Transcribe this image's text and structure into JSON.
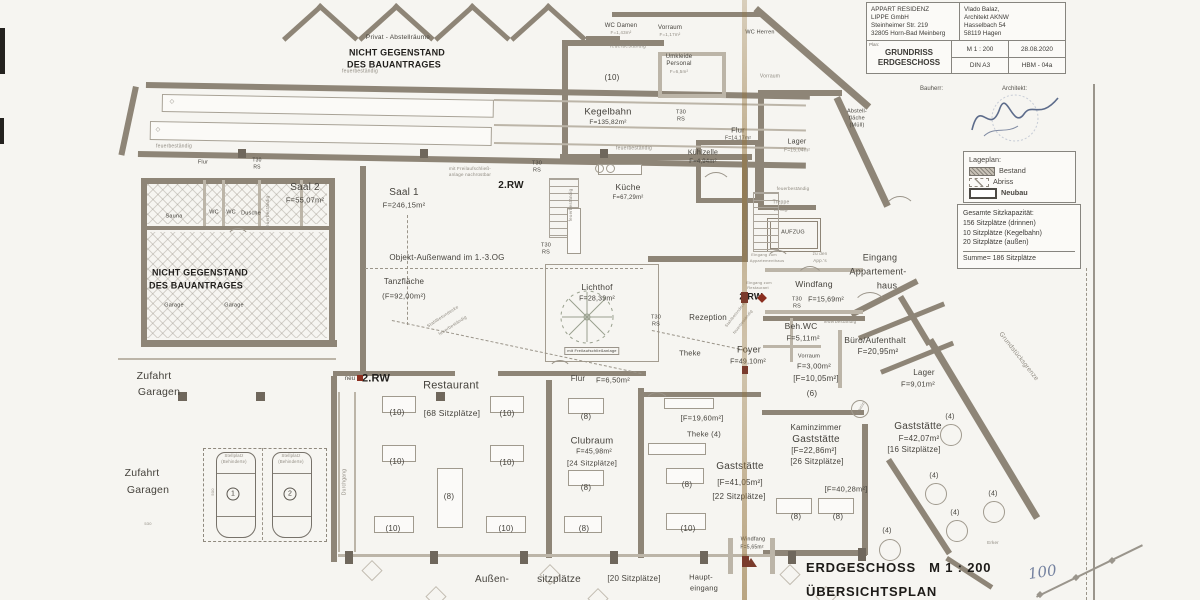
{
  "title_block": {
    "client": [
      "APPART RESIDENZ",
      "LIPPE  GmbH",
      "Steinheimer Str. 219",
      "32805 Horn-Bad Meinberg"
    ],
    "architect": [
      "Vlado Balaz,",
      "Architekt AKNW",
      "Hasselbach 54",
      "58119 Hagen"
    ],
    "plan_tag": "Plan:",
    "plan_name1": "GRUNDRISS",
    "plan_name2": "ERDGESCHOSS",
    "scale": "M 1 : 200",
    "date": "28.08.2020",
    "format": "DIN A3",
    "sheet": "HBM - 04a",
    "bauherr_label": "Bauherr:",
    "architekt_label": "Architekt:"
  },
  "legend": {
    "title": "Lageplan:",
    "items": [
      {
        "label": "Bestand",
        "style": "hatched"
      },
      {
        "label": "Abriss",
        "style": "dashed"
      },
      {
        "label": "Neubau",
        "style": "bold-outline"
      }
    ]
  },
  "capacity": {
    "lines": [
      "Gesamte Sitzkapazität:",
      "156 Sitzplätze (drinnen)",
      "10 Sitzplätze (Kegelbahn)",
      "20 Sitzplätze (außen)"
    ],
    "sum": "Summe= 186 Sitzplätze"
  },
  "footer": {
    "title": "ERDGESCHOSS   M 1 : 200",
    "subtitle": "ÜBERSICHTSPLAN",
    "handwritten": "100"
  },
  "plan": {
    "labels": [
      {
        "t": "Privat - Abstellräume",
        "x": 398,
        "y": 38,
        "s": 6.5
      },
      {
        "t": "NICHT GEGENSTAND",
        "x": 397,
        "y": 53,
        "s": 9,
        "b": 1
      },
      {
        "t": "DES BAUANTRAGES",
        "x": 394,
        "y": 65,
        "s": 9,
        "b": 1
      },
      {
        "t": "feuerbeständig",
        "x": 360,
        "y": 72,
        "s": 5,
        "c": "dim"
      },
      {
        "t": "feuerbeständig",
        "x": 174,
        "y": 147,
        "s": 5,
        "c": "dim"
      },
      {
        "t": "feuerbeständig",
        "x": 628,
        "y": 47,
        "s": 5,
        "c": "dim"
      },
      {
        "t": "feuerbeständig",
        "x": 634,
        "y": 149,
        "s": 5,
        "c": "dim"
      },
      {
        "t": "WC Damen",
        "x": 621,
        "y": 26,
        "s": 6
      },
      {
        "t": "F=1,43m²",
        "x": 621,
        "y": 33,
        "s": 4.5,
        "c": "dim"
      },
      {
        "t": "Vorraum",
        "x": 670,
        "y": 28,
        "s": 6
      },
      {
        "t": "F=1,17m²",
        "x": 670,
        "y": 35,
        "s": 4.5,
        "c": "dim"
      },
      {
        "t": "WC Herren",
        "x": 760,
        "y": 33,
        "s": 5.5
      },
      {
        "t": "Vorraum",
        "x": 770,
        "y": 77,
        "s": 5,
        "c": "dim"
      },
      {
        "t": "Umkleide",
        "x": 679,
        "y": 57,
        "s": 6
      },
      {
        "t": "Personal",
        "x": 679,
        "y": 64,
        "s": 6
      },
      {
        "t": "F=6,5m²",
        "x": 679,
        "y": 72,
        "s": 4.5,
        "c": "dim"
      },
      {
        "t": "(10)",
        "x": 612,
        "y": 78,
        "s": 8
      },
      {
        "t": "Kegelbahn",
        "x": 608,
        "y": 112,
        "s": 9.5
      },
      {
        "t": "F=135,82m²",
        "x": 608,
        "y": 123,
        "s": 6.5
      },
      {
        "t": "T30",
        "x": 681,
        "y": 113,
        "s": 5.5
      },
      {
        "t": "RS",
        "x": 681,
        "y": 120,
        "s": 5.5
      },
      {
        "t": "Kühlzelle",
        "x": 703,
        "y": 153,
        "s": 7
      },
      {
        "t": "F=4,94m²",
        "x": 703,
        "y": 162,
        "s": 6
      },
      {
        "t": "Flur",
        "x": 738,
        "y": 130,
        "s": 7.5
      },
      {
        "t": "F=14,17m²",
        "x": 738,
        "y": 139,
        "s": 5
      },
      {
        "t": "Küche",
        "x": 628,
        "y": 187,
        "s": 8.5
      },
      {
        "t": "F=67,29m²",
        "x": 628,
        "y": 198,
        "s": 6
      },
      {
        "t": "Saal 2",
        "x": 305,
        "y": 188,
        "s": 10
      },
      {
        "t": "F=55,07m²",
        "x": 305,
        "y": 200,
        "s": 7.5
      },
      {
        "t": "Saal 1",
        "x": 404,
        "y": 193,
        "s": 10
      },
      {
        "t": "F=246,15m²",
        "x": 404,
        "y": 205,
        "s": 7.5
      },
      {
        "t": "2.RW",
        "x": 511,
        "y": 186,
        "s": 10,
        "b": 1
      },
      {
        "t": "mit Freilaufschließ-",
        "x": 470,
        "y": 169,
        "s": 4.5,
        "c": "dim"
      },
      {
        "t": "anlage nachrüstbar",
        "x": 470,
        "y": 175,
        "s": 4.5,
        "c": "dim"
      },
      {
        "t": "T30",
        "x": 537,
        "y": 164,
        "s": 5.5
      },
      {
        "t": "RS",
        "x": 537,
        "y": 171,
        "s": 5.5
      },
      {
        "t": "T30",
        "x": 546,
        "y": 246,
        "s": 5.5
      },
      {
        "t": "RS",
        "x": 546,
        "y": 253,
        "s": 5.5
      },
      {
        "t": "Objekt-Außenwand im 1.-3.OG",
        "x": 447,
        "y": 258,
        "s": 8
      },
      {
        "t": "Tanzfläche",
        "x": 404,
        "y": 282,
        "s": 8
      },
      {
        "t": "(F=92,00m²)",
        "x": 404,
        "y": 296,
        "s": 7.5
      },
      {
        "t": "Lichthof",
        "x": 597,
        "y": 287,
        "s": 8.5
      },
      {
        "t": "F=28,39m²",
        "x": 597,
        "y": 299,
        "s": 7
      },
      {
        "t": "mit Freilaufschließanlage",
        "x": 592,
        "y": 351,
        "s": 4,
        "c": "boxed"
      },
      {
        "t": "Rezeption",
        "x": 708,
        "y": 318,
        "s": 8
      },
      {
        "t": "Theke",
        "x": 690,
        "y": 353,
        "s": 7.5
      },
      {
        "t": "Foyer",
        "x": 749,
        "y": 350,
        "s": 9
      },
      {
        "t": "F=49,10m²",
        "x": 748,
        "y": 362,
        "s": 7
      },
      {
        "t": "T30",
        "x": 656,
        "y": 318,
        "s": 5.5
      },
      {
        "t": "RS",
        "x": 656,
        "y": 325,
        "s": 5.5
      },
      {
        "t": "Eingang zum",
        "x": 759,
        "y": 283,
        "s": 4,
        "c": "dim"
      },
      {
        "t": "Restaurant",
        "x": 758,
        "y": 288,
        "s": 4,
        "c": "dim"
      },
      {
        "t": "2.RW",
        "x": 751,
        "y": 297,
        "s": 9,
        "b": 1
      },
      {
        "t": "Stahlbetondecke",
        "x": 736,
        "y": 314,
        "s": 4,
        "r": -52,
        "c": "dim"
      },
      {
        "t": "feuerbeständig",
        "x": 743,
        "y": 322,
        "s": 4,
        "r": -52,
        "c": "dim"
      },
      {
        "t": "Stahlbetondecke",
        "x": 443,
        "y": 317,
        "s": 4.5,
        "r": -33,
        "c": "dim"
      },
      {
        "t": "feuerbeständig",
        "x": 453,
        "y": 326,
        "s": 4.5,
        "r": -33,
        "c": "dim"
      },
      {
        "t": "feuerbeständig",
        "x": 268,
        "y": 212,
        "s": 4.5,
        "r": -90,
        "c": "dim"
      },
      {
        "t": "feuerbeständig",
        "x": 571,
        "y": 205,
        "s": 4.5,
        "r": -90,
        "c": "dim"
      },
      {
        "t": "feuerbeständig",
        "x": 745,
        "y": 237,
        "s": 4.5,
        "r": -90,
        "c": "dim"
      },
      {
        "t": "Sauna",
        "x": 174,
        "y": 217,
        "s": 5.5
      },
      {
        "t": "WC",
        "x": 214,
        "y": 213,
        "s": 5.5
      },
      {
        "t": "WC",
        "x": 231,
        "y": 213,
        "s": 5.5
      },
      {
        "t": "Dusche",
        "x": 251,
        "y": 214,
        "s": 5.5
      },
      {
        "t": "NICHT GEGENSTAND",
        "x": 200,
        "y": 273,
        "s": 9,
        "b": 1
      },
      {
        "t": "DES BAUANTRAGES",
        "x": 196,
        "y": 286,
        "s": 9,
        "b": 1
      },
      {
        "t": "Garage",
        "x": 174,
        "y": 306,
        "s": 5.5
      },
      {
        "t": "Garage",
        "x": 234,
        "y": 306,
        "s": 5.5
      },
      {
        "t": "Flur",
        "x": 203,
        "y": 163,
        "s": 5.5
      },
      {
        "t": "T30",
        "x": 257,
        "y": 161,
        "s": 5
      },
      {
        "t": "RS",
        "x": 257,
        "y": 168,
        "s": 5
      },
      {
        "t": "Zufahrt",
        "x": 154,
        "y": 376,
        "s": 10.5
      },
      {
        "t": "Garagen",
        "x": 159,
        "y": 392,
        "s": 10.5
      },
      {
        "t": "Zufahrt",
        "x": 142,
        "y": 473,
        "s": 10.5
      },
      {
        "t": "Garagen",
        "x": 148,
        "y": 490,
        "s": 10.5
      },
      {
        "t": "Stellplatz",
        "x": 234,
        "y": 456,
        "s": 4.2,
        "c": "dim"
      },
      {
        "t": "(Behinderte)",
        "x": 234,
        "y": 462,
        "s": 4.2,
        "c": "dim"
      },
      {
        "t": "Stellplatz",
        "x": 291,
        "y": 456,
        "s": 4.2,
        "c": "dim"
      },
      {
        "t": "(Behinderte)",
        "x": 291,
        "y": 462,
        "s": 4.2,
        "c": "dim"
      },
      {
        "t": "1",
        "x": 233,
        "y": 494,
        "s": 7,
        "c": "circle"
      },
      {
        "t": "2",
        "x": 290,
        "y": 494,
        "s": 7,
        "c": "circle"
      },
      {
        "t": "530",
        "x": 148,
        "y": 524,
        "s": 4,
        "c": "dim"
      },
      {
        "t": "500",
        "x": 213,
        "y": 492,
        "s": 4,
        "r": -90,
        "c": "dim"
      },
      {
        "t": "Durchgang",
        "x": 345,
        "y": 482,
        "s": 5,
        "r": -90,
        "c": "dim"
      },
      {
        "t": "neu",
        "x": 350,
        "y": 379,
        "s": 6
      },
      {
        "t": "2.RW",
        "x": 376,
        "y": 379,
        "s": 11,
        "b": 1
      },
      {
        "t": "Restaurant",
        "x": 451,
        "y": 386,
        "s": 11
      },
      {
        "t": "[68 Sitzplätze]",
        "x": 452,
        "y": 413,
        "s": 8.5
      },
      {
        "t": "(10)",
        "x": 397,
        "y": 413,
        "s": 8
      },
      {
        "t": "(10)",
        "x": 507,
        "y": 414,
        "s": 8
      },
      {
        "t": "(10)",
        "x": 397,
        "y": 462,
        "s": 8
      },
      {
        "t": "(10)",
        "x": 507,
        "y": 463,
        "s": 8
      },
      {
        "t": "(8)",
        "x": 449,
        "y": 497,
        "s": 8
      },
      {
        "t": "(10)",
        "x": 393,
        "y": 529,
        "s": 8
      },
      {
        "t": "(10)",
        "x": 506,
        "y": 529,
        "s": 8
      },
      {
        "t": "Flur",
        "x": 578,
        "y": 379,
        "s": 8
      },
      {
        "t": "F=6,50m²",
        "x": 613,
        "y": 380,
        "s": 7.5
      },
      {
        "t": "Clubraum",
        "x": 592,
        "y": 441,
        "s": 9.5
      },
      {
        "t": "F=45,98m²",
        "x": 594,
        "y": 452,
        "s": 7
      },
      {
        "t": "[24 Sitzplätze]",
        "x": 592,
        "y": 463,
        "s": 7.5
      },
      {
        "t": "(8)",
        "x": 586,
        "y": 417,
        "s": 8
      },
      {
        "t": "(8)",
        "x": 586,
        "y": 488,
        "s": 8
      },
      {
        "t": "(8)",
        "x": 584,
        "y": 529,
        "s": 8
      },
      {
        "t": "[F=19,60m²]",
        "x": 702,
        "y": 418,
        "s": 7.5
      },
      {
        "t": "Theke (4)",
        "x": 704,
        "y": 434,
        "s": 7.5
      },
      {
        "t": "Gaststätte",
        "x": 740,
        "y": 467,
        "s": 10
      },
      {
        "t": "[F=41,05m²]",
        "x": 740,
        "y": 483,
        "s": 8
      },
      {
        "t": "[22 Sitzplätze]",
        "x": 739,
        "y": 497,
        "s": 8
      },
      {
        "t": "(8)",
        "x": 687,
        "y": 485,
        "s": 8
      },
      {
        "t": "(10)",
        "x": 688,
        "y": 529,
        "s": 8
      },
      {
        "t": "Windfang",
        "x": 753,
        "y": 540,
        "s": 5.5
      },
      {
        "t": "F=5,65m²",
        "x": 752,
        "y": 548,
        "s": 5
      },
      {
        "t": "Haupt-",
        "x": 701,
        "y": 577,
        "s": 7.5
      },
      {
        "t": "eingang",
        "x": 704,
        "y": 588,
        "s": 7.5
      },
      {
        "t": "Kaminzimmer",
        "x": 816,
        "y": 428,
        "s": 8
      },
      {
        "t": "Gaststätte",
        "x": 816,
        "y": 440,
        "s": 10
      },
      {
        "t": "[F=22,86m²]",
        "x": 814,
        "y": 451,
        "s": 8
      },
      {
        "t": "[26 Sitzplätze]",
        "x": 817,
        "y": 462,
        "s": 8
      },
      {
        "t": "[F=40,28m²]",
        "x": 846,
        "y": 489,
        "s": 7.5
      },
      {
        "t": "(8)",
        "x": 796,
        "y": 517,
        "s": 8
      },
      {
        "t": "(8)",
        "x": 838,
        "y": 517,
        "s": 8
      },
      {
        "t": "Gaststätte",
        "x": 918,
        "y": 427,
        "s": 10
      },
      {
        "t": "F=42,07m²",
        "x": 919,
        "y": 439,
        "s": 8
      },
      {
        "t": "[16 Sitzplätze]",
        "x": 914,
        "y": 450,
        "s": 8
      },
      {
        "t": "(4)",
        "x": 950,
        "y": 417,
        "s": 7
      },
      {
        "t": "(4)",
        "x": 934,
        "y": 476,
        "s": 7
      },
      {
        "t": "(4)",
        "x": 993,
        "y": 494,
        "s": 7
      },
      {
        "t": "(4)",
        "x": 955,
        "y": 513,
        "s": 7
      },
      {
        "t": "(4)",
        "x": 887,
        "y": 531,
        "s": 7
      },
      {
        "t": "Lager",
        "x": 924,
        "y": 373,
        "s": 8
      },
      {
        "t": "F=9,01m²",
        "x": 918,
        "y": 384,
        "s": 7.5
      },
      {
        "t": "Lager",
        "x": 797,
        "y": 142,
        "s": 7
      },
      {
        "t": "F=15,04m²",
        "x": 797,
        "y": 151,
        "s": 5,
        "c": "dim"
      },
      {
        "t": "Abstell-",
        "x": 857,
        "y": 112,
        "s": 5.5
      },
      {
        "t": "fläche",
        "x": 857,
        "y": 119,
        "s": 5.5
      },
      {
        "t": "(Müll)",
        "x": 857,
        "y": 126,
        "s": 5.5
      },
      {
        "t": "Treppe",
        "x": 781,
        "y": 203,
        "s": 5,
        "c": "dim"
      },
      {
        "t": "18 Stg.",
        "x": 781,
        "y": 210,
        "s": 4.2,
        "c": "dim"
      },
      {
        "t": "AUFZUG",
        "x": 793,
        "y": 233,
        "s": 5.5
      },
      {
        "t": "Eingang zum",
        "x": 764,
        "y": 255,
        "s": 4,
        "c": "dim"
      },
      {
        "t": "Appartementhaus",
        "x": 767,
        "y": 261,
        "s": 4,
        "c": "dim"
      },
      {
        "t": "zu den",
        "x": 820,
        "y": 254,
        "s": 4.5,
        "c": "dim"
      },
      {
        "t": "App.'s",
        "x": 820,
        "y": 261,
        "s": 4.5,
        "c": "dim"
      },
      {
        "t": "Eingang",
        "x": 880,
        "y": 258,
        "s": 9
      },
      {
        "t": "Appartement-",
        "x": 878,
        "y": 272,
        "s": 9
      },
      {
        "t": "haus",
        "x": 887,
        "y": 286,
        "s": 9
      },
      {
        "t": "Windfang",
        "x": 814,
        "y": 284,
        "s": 8.5
      },
      {
        "t": "T30",
        "x": 797,
        "y": 300,
        "s": 5.5
      },
      {
        "t": "F=15,69m²",
        "x": 826,
        "y": 300,
        "s": 7
      },
      {
        "t": "RS",
        "x": 797,
        "y": 307,
        "s": 5.5
      },
      {
        "t": "feuerbeständig",
        "x": 793,
        "y": 189,
        "s": 4.5,
        "c": "dim"
      },
      {
        "t": "feuerbeständig",
        "x": 840,
        "y": 322,
        "s": 4.5,
        "c": "dim"
      },
      {
        "t": "Beh.WC",
        "x": 801,
        "y": 326,
        "s": 8.5
      },
      {
        "t": "F=5,11m²",
        "x": 803,
        "y": 338,
        "s": 7.5
      },
      {
        "t": "Büro/Aufenthalt",
        "x": 875,
        "y": 340,
        "s": 8.5
      },
      {
        "t": "F=20,95m²",
        "x": 878,
        "y": 352,
        "s": 8
      },
      {
        "t": "Vorraum",
        "x": 809,
        "y": 357,
        "s": 5.5
      },
      {
        "t": "F=3,00m²",
        "x": 814,
        "y": 366,
        "s": 7.5
      },
      {
        "t": "[F=10,05m²]",
        "x": 816,
        "y": 379,
        "s": 8
      },
      {
        "t": "(6)",
        "x": 812,
        "y": 394,
        "s": 8
      },
      {
        "t": "Grundstücksgrenze",
        "x": 1018,
        "y": 357,
        "s": 6.5,
        "r": 52,
        "c": "dim"
      },
      {
        "t": "Erker",
        "x": 993,
        "y": 543,
        "s": 4.5,
        "c": "dim"
      },
      {
        "t": "Kamin",
        "x": 861,
        "y": 408,
        "s": 4.2,
        "r": -60,
        "c": "dim"
      },
      {
        "t": "Außen-",
        "x": 492,
        "y": 580,
        "s": 10
      },
      {
        "t": "sitzplätze",
        "x": 559,
        "y": 580,
        "s": 10
      },
      {
        "t": "[20 Sitzplätze]",
        "x": 634,
        "y": 579,
        "s": 8
      },
      {
        "t": "◇",
        "x": 172,
        "y": 102,
        "s": 6,
        "c": "dim"
      },
      {
        "t": "◇",
        "x": 158,
        "y": 130,
        "s": 6,
        "c": "dim"
      }
    ]
  }
}
